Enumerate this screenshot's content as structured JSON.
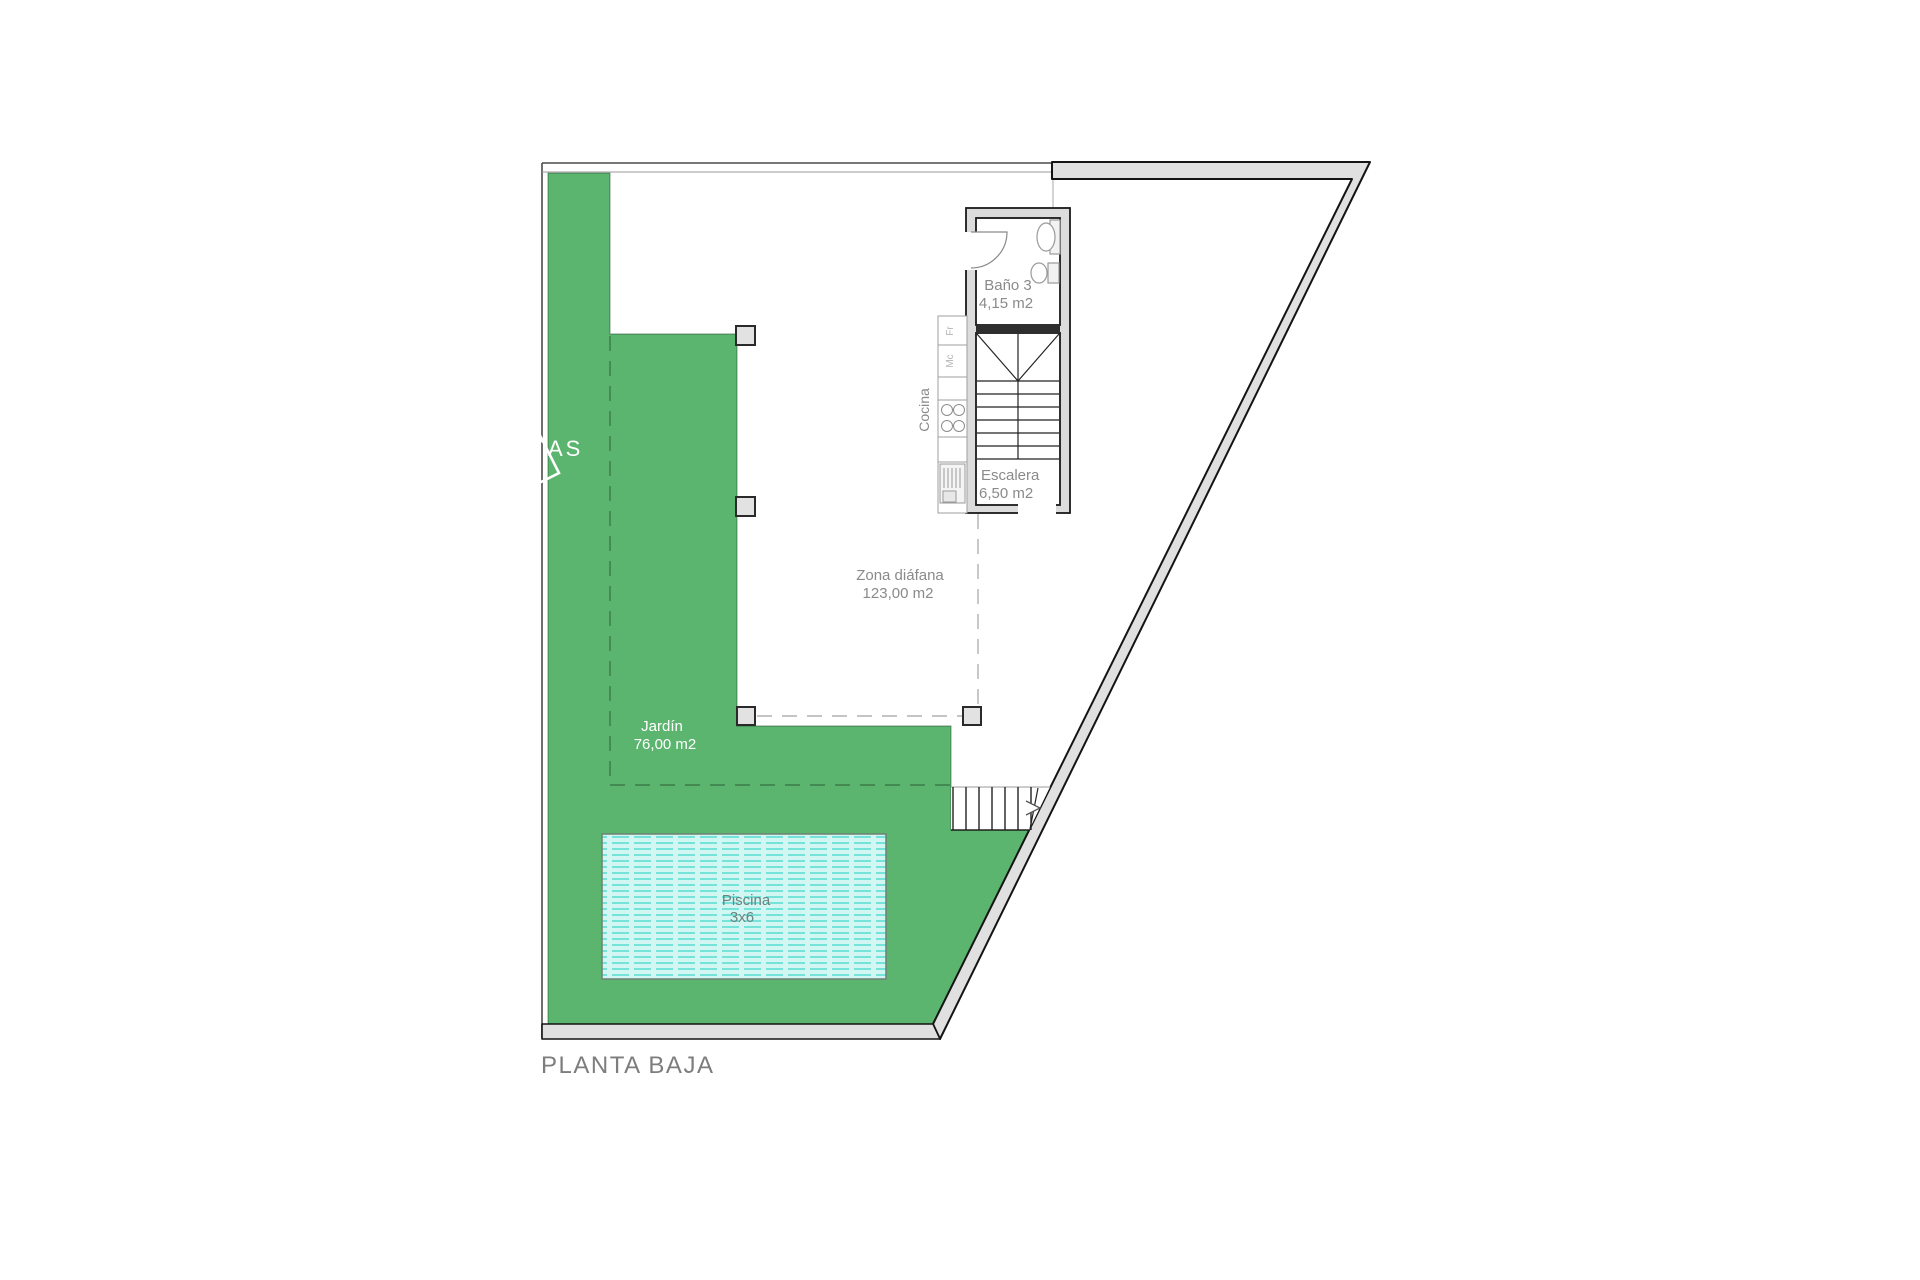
{
  "title": {
    "label": "PLANTA BAJA"
  },
  "garden": {
    "name": "Jardín",
    "area": "76,00 m2",
    "vistas_label": "VISTAS",
    "color": "#5bb56e"
  },
  "pool": {
    "name": "Piscina",
    "size": "3x6",
    "fill": "#d2f6f1",
    "stripe": "#3ed8cd"
  },
  "open_zone": {
    "name": "Zona diáfana",
    "area": "123,00 m2"
  },
  "bathroom": {
    "name": "Baño 3",
    "area": "4,15 m2"
  },
  "stairwell": {
    "name": "Escalera",
    "area": "6,50 m2"
  },
  "kitchen": {
    "name": "Cocina",
    "fridge_label": "Fr",
    "microwave_label": "Mc"
  },
  "colors": {
    "wall_fill": "#e0e0e0",
    "wall_line": "#1a1a1a",
    "thin_line": "#555555",
    "dash_grey": "#b0b0b0",
    "text_grey": "#8a8a8a",
    "text_white": "#ffffff",
    "title_grey": "#7d7d7d"
  }
}
